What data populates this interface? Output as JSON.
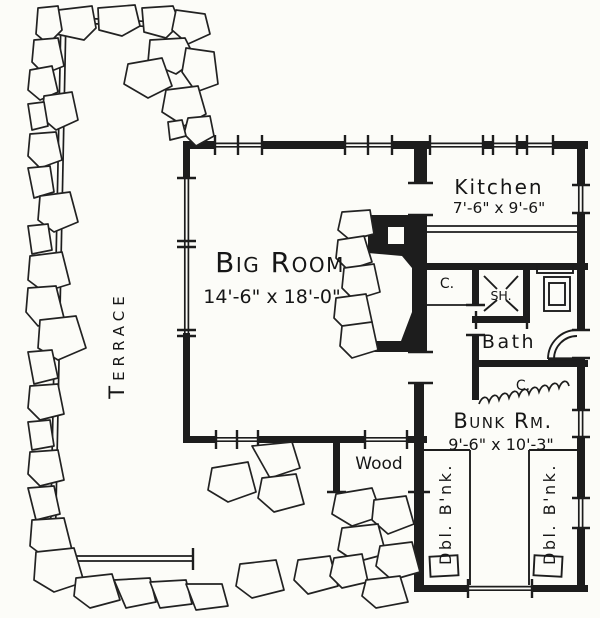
{
  "colors": {
    "ink": "#1d1d1d",
    "paper": "#fcfcf8"
  },
  "labels": {
    "terrace": "Terrace",
    "big_room": {
      "name": "Big Room",
      "dims": "14'-6\" x 18'-0\""
    },
    "kitchen": {
      "name": "Kitchen",
      "dims": "7'-6\" x 9'-6\""
    },
    "bath": "Bath",
    "shower": "SH.",
    "closet_hall": "C.",
    "closet_bunk": "C.",
    "bunk_room": {
      "name": "Bunk Rm.",
      "dims": "9'-6\" x 10'-3\""
    },
    "wood": "Wood",
    "bunk_left": "Dbl. B'nk.",
    "bunk_right": "Dbl. B'nk."
  }
}
